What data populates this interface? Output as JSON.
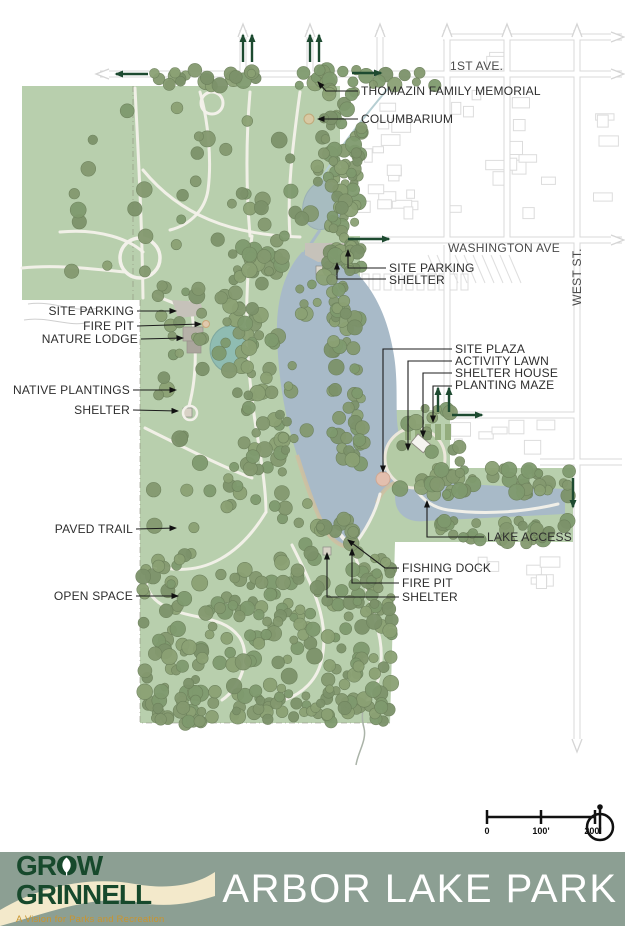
{
  "map": {
    "streets": {
      "first_ave": "1ST AVE.",
      "washington_ave": "WASHINGTON AVE",
      "west_st": "WEST ST."
    },
    "labels": [
      {
        "id": "thomazin-family-memorial",
        "text": "THOMAZIN FAMILY MEMORIAL"
      },
      {
        "id": "columbarium",
        "text": "COLUMBARIUM"
      },
      {
        "id": "site-parking-north",
        "text": "SITE PARKING"
      },
      {
        "id": "shelter-north",
        "text": "SHELTER"
      },
      {
        "id": "site-parking-west",
        "text": "SITE PARKING"
      },
      {
        "id": "fire-pit-west",
        "text": "FIRE PIT"
      },
      {
        "id": "nature-lodge",
        "text": "NATURE LODGE"
      },
      {
        "id": "native-plantings",
        "text": "NATIVE PLANTINGS"
      },
      {
        "id": "shelter-west",
        "text": "SHELTER"
      },
      {
        "id": "site-plaza",
        "text": "SITE PLAZA"
      },
      {
        "id": "activity-lawn",
        "text": "ACTIVITY LAWN"
      },
      {
        "id": "shelter-house",
        "text": "SHELTER HOUSE"
      },
      {
        "id": "planting-maze",
        "text": "PLANTING MAZE"
      },
      {
        "id": "paved-trail",
        "text": "PAVED TRAIL"
      },
      {
        "id": "open-space",
        "text": "OPEN SPACE"
      },
      {
        "id": "lake-access",
        "text": "LAKE ACCESS"
      },
      {
        "id": "fishing-dock",
        "text": "FISHING DOCK"
      },
      {
        "id": "fire-pit-south",
        "text": "FIRE PIT"
      },
      {
        "id": "shelter-south",
        "text": "SHELTER"
      }
    ],
    "scale_bar": {
      "ticks": [
        "0",
        "100'",
        "200'"
      ]
    }
  },
  "footer": {
    "logo": {
      "line1": "GROW",
      "line2": "GRINNELL",
      "tagline": "A Vision for Parks and Recreation"
    },
    "title": "ARBOR LAKE PARK"
  },
  "colors": {
    "banner_green": "#8c9f93",
    "logo_green": "#17492c",
    "tagline_gold": "#c9952f",
    "cream_wave": "#f3e9cb",
    "park_green": "#b8cfad",
    "tree_green": "#83986d",
    "lake_blue": "#a8bac8",
    "pond_teal": "#8fbcb2",
    "entry_arrow_green": "#1d4a30",
    "street_gray": "#d8d8d8",
    "beach_tan": "#cfc0a0",
    "plaza_pink": "#e3bfae"
  }
}
